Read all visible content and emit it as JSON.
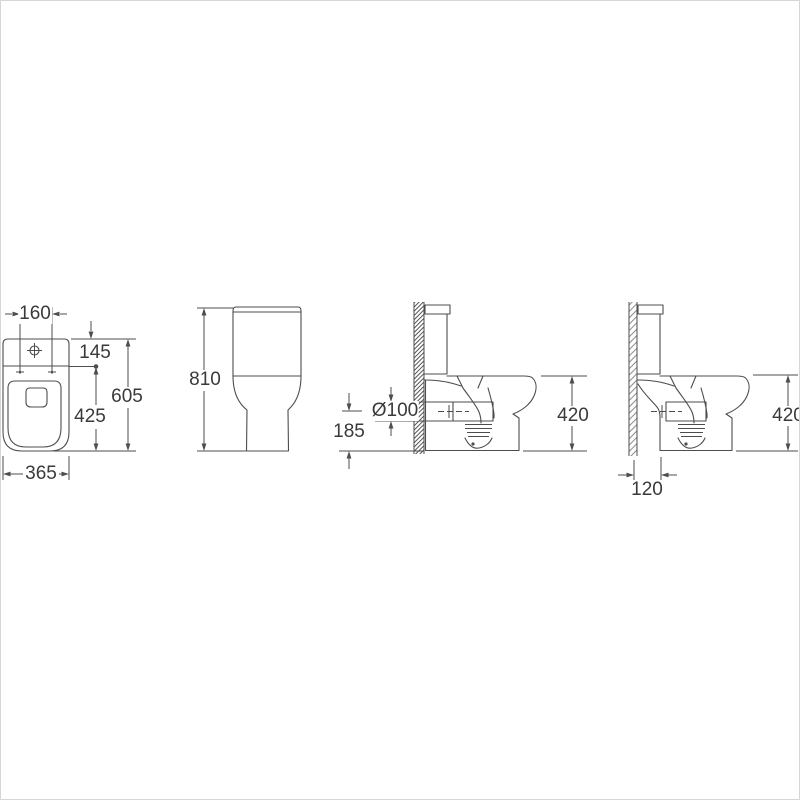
{
  "colors": {
    "background": "#ffffff",
    "line": "#4d4d4d",
    "text": "#3a3a3a",
    "border": "#d7d7d7"
  },
  "views": {
    "plan": {
      "dims": {
        "fixing_centers": "160",
        "back_to_fixings": "145",
        "fixings_to_front": "425",
        "overall_depth": "605",
        "overall_width": "365"
      }
    },
    "front": {
      "dims": {
        "overall_height": "810"
      }
    },
    "side": {
      "dims": {
        "outlet_height": "185",
        "outlet_diameter": "Ø100",
        "pan_height": "420"
      }
    },
    "side_back_to_wall": {
      "dims": {
        "wall_clearance": "120",
        "pan_height": "420"
      }
    }
  }
}
